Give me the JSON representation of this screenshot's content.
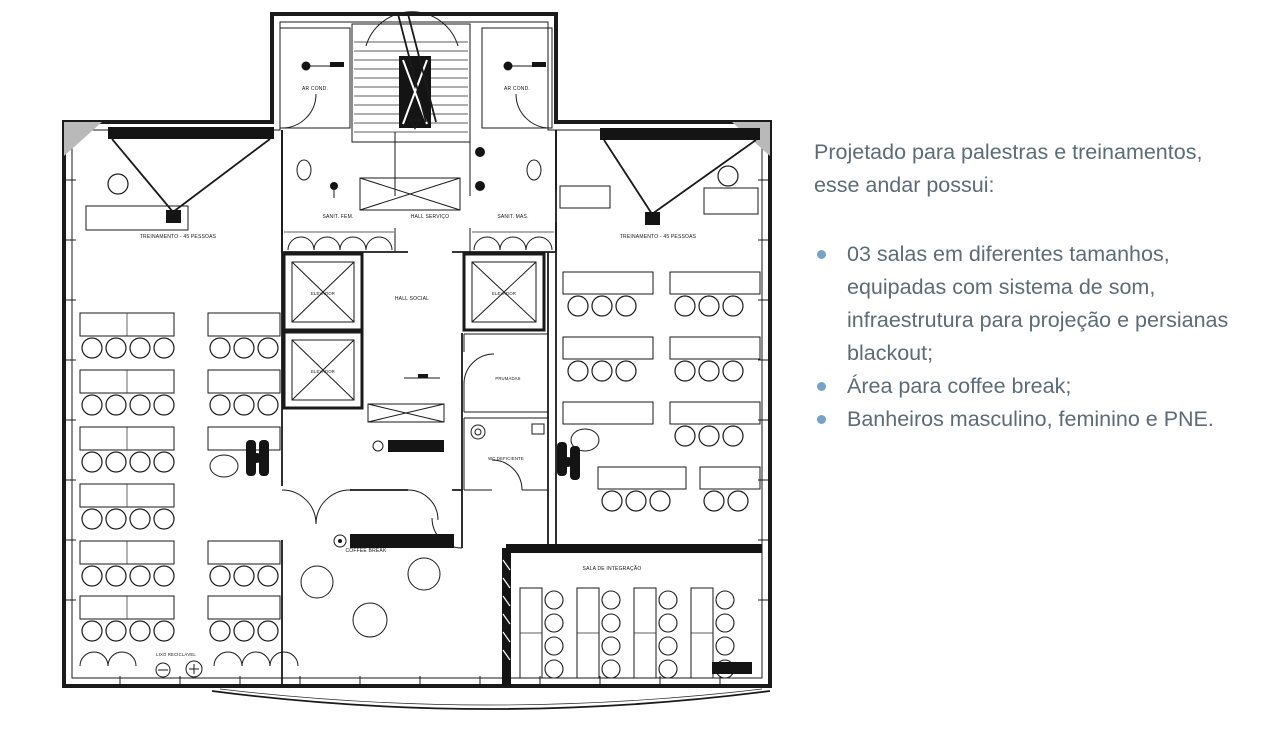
{
  "panel": {
    "intro": "Projetado para palestras e treinamentos, esse andar possui:",
    "bullets": [
      "03 salas em diferentes tamanhos, equipadas com sistema de som, infraestrutura para projeção e persianas blackout;",
      "Área para coffee break;",
      "Banheiros masculino, feminino e PNE."
    ],
    "text_color": "#5c6b75",
    "bullet_color": "#74a3c7"
  },
  "floorplan": {
    "line_color": "#1a1a1a",
    "labels": {
      "treinamento": "TREINAMENTO - 45 PESSOAS",
      "ar_cond": "AR COND.",
      "sanit_fem": "SANIT. FEM.",
      "hall_servico": "HALL SERVIÇO",
      "sanit_mas": "SANIT. MAS.",
      "hall_social": "HALL SOCIAL",
      "elevador": "ELEVADOR",
      "prumadas": "PRUMADAS",
      "wc_deficiente": "WC DEFICIENTE",
      "coffee_break": "COFFEE BREAK",
      "sala_integracao": "SALA DE INTEGRAÇÃO",
      "lixo_reciclavel": "LIXO RECICLÁVEL"
    }
  }
}
